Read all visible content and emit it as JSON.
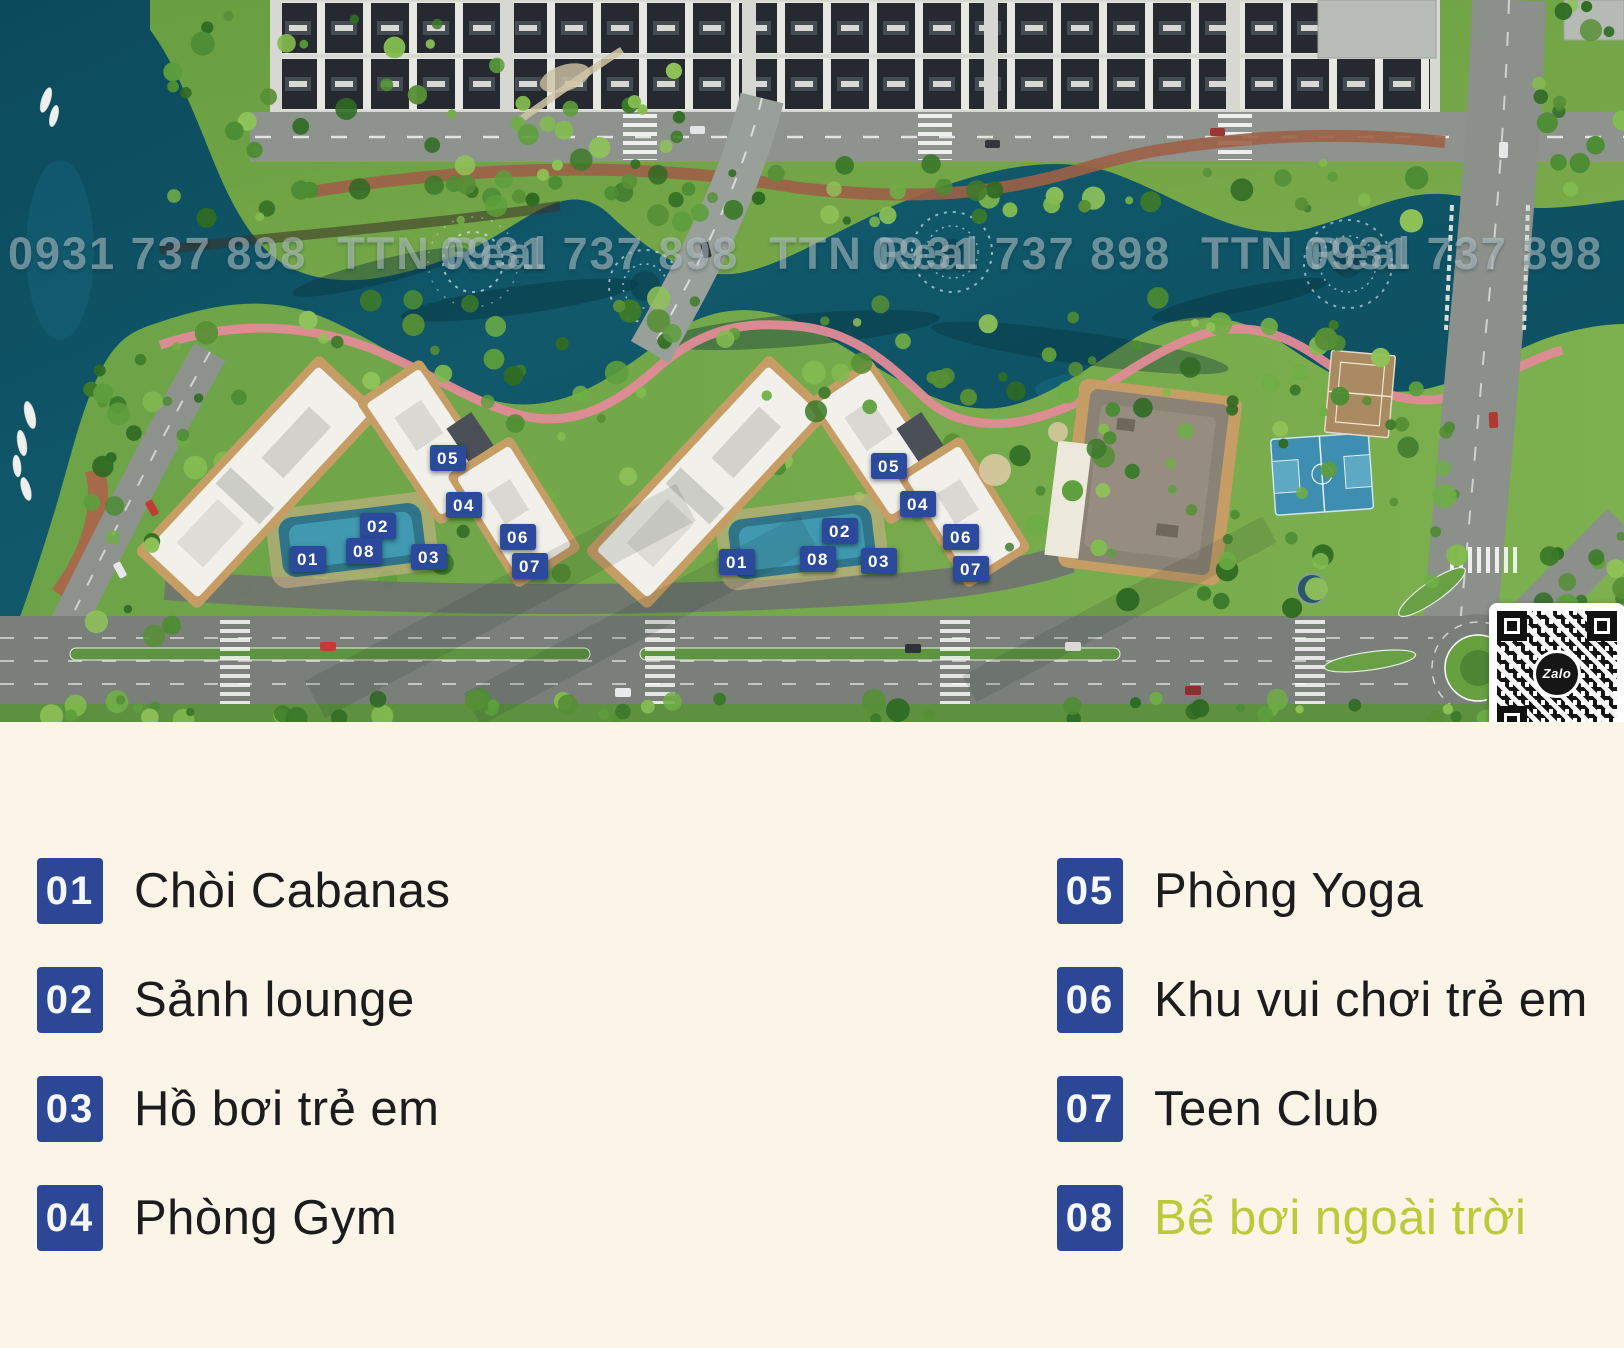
{
  "map": {
    "watermark": {
      "phone": "0931 737 898",
      "brand": "TTN Real",
      "repetitions": 4
    },
    "qr": {
      "label": "Zalo"
    },
    "markers": [
      {
        "label": "01",
        "x": 308,
        "y": 559
      },
      {
        "label": "02",
        "x": 378,
        "y": 526
      },
      {
        "label": "03",
        "x": 429,
        "y": 557
      },
      {
        "label": "04",
        "x": 464,
        "y": 505
      },
      {
        "label": "05",
        "x": 448,
        "y": 458
      },
      {
        "label": "06",
        "x": 518,
        "y": 537
      },
      {
        "label": "07",
        "x": 530,
        "y": 566
      },
      {
        "label": "08",
        "x": 364,
        "y": 551
      },
      {
        "label": "01",
        "x": 737,
        "y": 562
      },
      {
        "label": "02",
        "x": 840,
        "y": 531
      },
      {
        "label": "03",
        "x": 879,
        "y": 561
      },
      {
        "label": "04",
        "x": 918,
        "y": 504
      },
      {
        "label": "05",
        "x": 889,
        "y": 466
      },
      {
        "label": "06",
        "x": 961,
        "y": 537
      },
      {
        "label": "07",
        "x": 971,
        "y": 569
      },
      {
        "label": "08",
        "x": 818,
        "y": 559
      }
    ]
  },
  "legend": {
    "items": [
      {
        "num": "01",
        "label": "Chòi Cabanas"
      },
      {
        "num": "02",
        "label": "Sảnh lounge"
      },
      {
        "num": "03",
        "label": "Hồ bơi trẻ em"
      },
      {
        "num": "04",
        "label": "Phòng Gym"
      },
      {
        "num": "05",
        "label": "Phòng Yoga"
      },
      {
        "num": "06",
        "label": "Khu vui chơi trẻ em"
      },
      {
        "num": "07",
        "label": "Teen Club"
      },
      {
        "num": "08",
        "label": "Bể bơi ngoài trời",
        "highlight": true
      }
    ]
  },
  "colors": {
    "badge_blue": "#2b4a9b",
    "legend_badge": "#2c4795",
    "highlight_text": "#bcc938",
    "background_cream": "#faf5e7"
  }
}
